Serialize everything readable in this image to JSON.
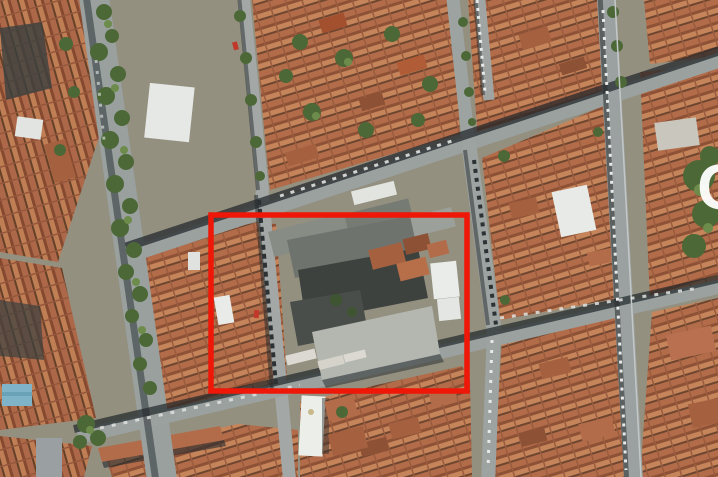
{
  "scene": {
    "type": "aerial-satellite-photo",
    "description": "dense European city blocks with terracotta rooftops, tilted street grid, tree-lined boulevard on the left, large gray-roofed complex highlighted in the center"
  },
  "annotation": {
    "shape": "rectangle",
    "color": "#ee1708",
    "x": 211,
    "y": 215,
    "width": 256,
    "height": 176,
    "stroke_width": 5.5
  },
  "watermark": {
    "letter": "G",
    "color": "#ffffff"
  },
  "palette": {
    "street": "#9ba1a0",
    "street_shadow": "#23292c",
    "terracotta": "#b26c49",
    "terracotta_dark": "#8d5136",
    "terracotta_light": "#c5845a",
    "roof_gray_dark": "#3e423f",
    "roof_gray": "#6e736d",
    "concrete": "#b3b7b0",
    "tree_green": "#4c6837",
    "tree_green_light": "#6d8c4b",
    "white_building": "#eaece9",
    "blue_roof": "#7fb3c8",
    "car_light": "#e7eae8",
    "car_dark": "#2c3134"
  }
}
